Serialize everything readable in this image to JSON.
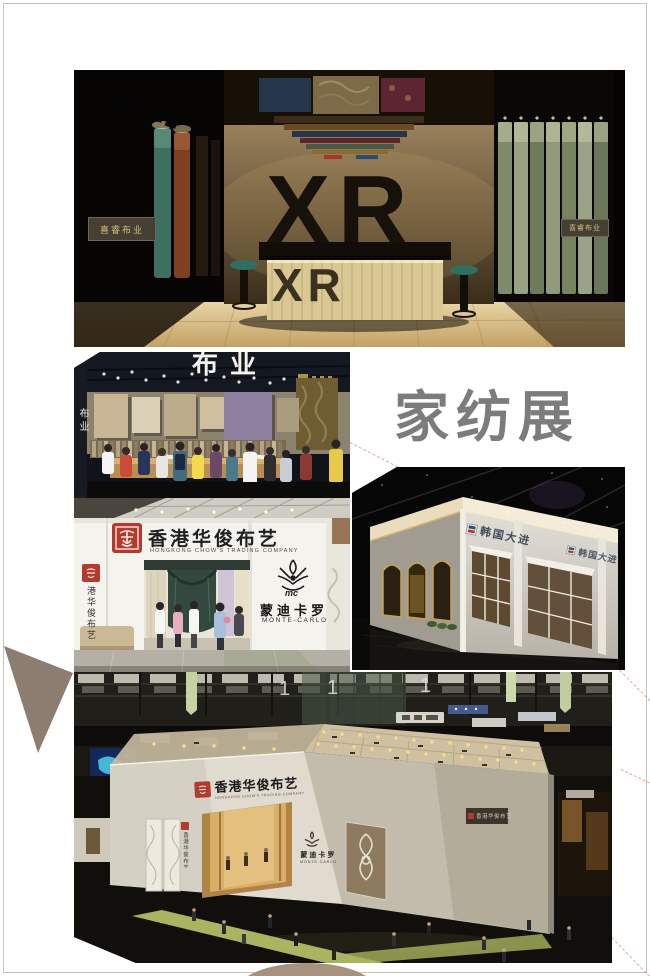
{
  "page": {
    "title": "家纺展"
  },
  "photo_xr": {
    "wall_logo": "XR",
    "desk_logo": "XR",
    "plaque_left": "喜睿布业",
    "plaque_right": "喜睿布业"
  },
  "photo_crowd": {
    "header_partial": "布业",
    "side_vertical": "布业"
  },
  "photo_huajun": {
    "brand_cn": "香港华俊布艺",
    "brand_en": "HONGKONG CHOW'S TRADING COMPANY",
    "pillar_vertical": "港华俊布艺",
    "monte_cn": "蒙迪卡罗",
    "monte_en": "MONTE-CARLO"
  },
  "photo_daejin": {
    "sign_front": "韩国大进",
    "sign_side": "韩国大进"
  },
  "photo_aerial": {
    "banner_1": "1",
    "brand_cn": "香港华俊布艺",
    "brand_en": "HONGKONG CHOW'S TRADING COMPANY",
    "pillar_vertical": "香港华俊布艺",
    "monte_cn": "蒙迪卡罗",
    "monte_en": "MONTE-CARLO",
    "wall_sign": "香港华俊布艺"
  },
  "colors": {
    "seal_red": "#b23a2e",
    "title_gray": "#7c7c7c",
    "triangle_taupe": "#8d7c70"
  }
}
